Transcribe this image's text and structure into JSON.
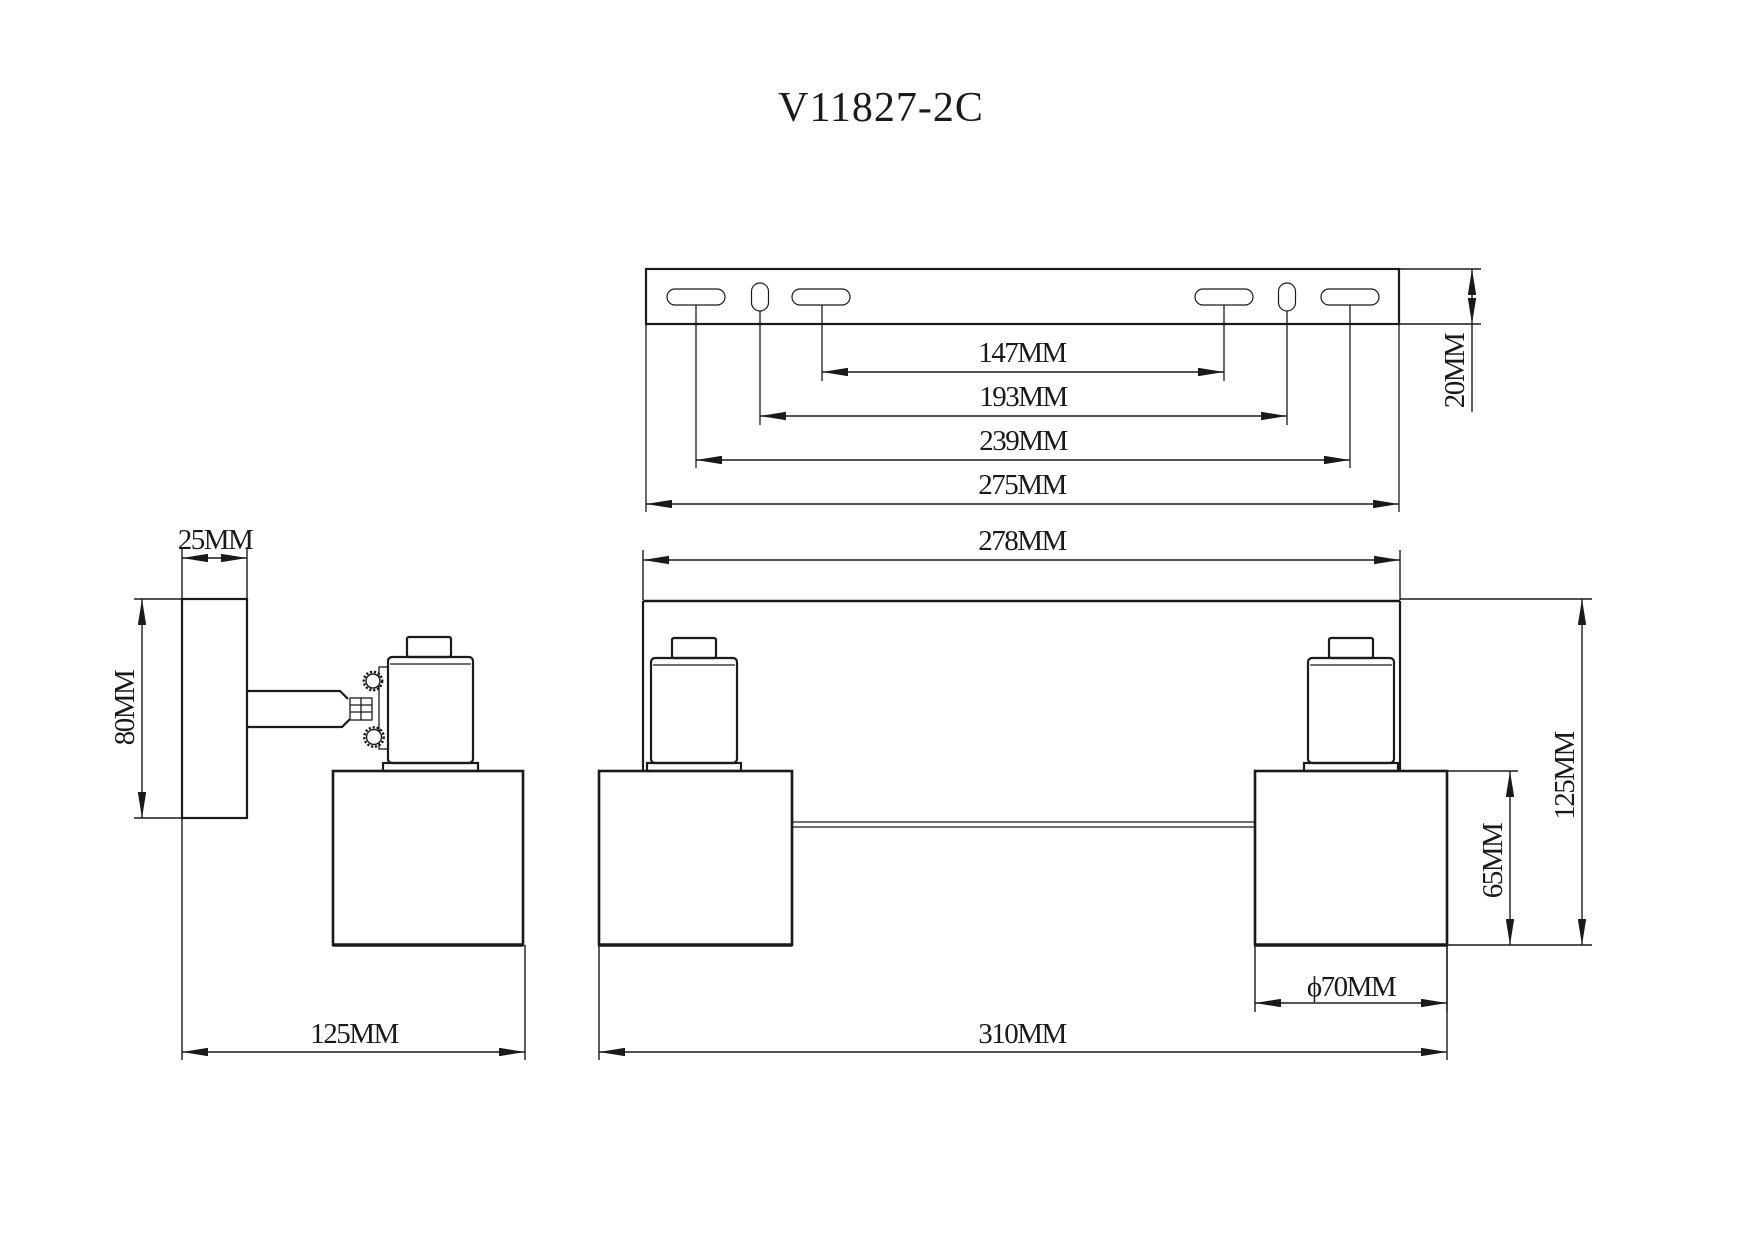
{
  "title": "V11827-2C",
  "drawing": {
    "background": "#ffffff",
    "line_color": "#1a1a1a"
  },
  "dimensions": {
    "bracket": {
      "d147": "147MM",
      "d193": "193MM",
      "d239": "239MM",
      "d275": "275MM",
      "d20": "20MM"
    },
    "front": {
      "d278": "278MM",
      "d65": "65MM",
      "d125": "125MM",
      "d70": "ϕ70MM",
      "d310": "310MM"
    },
    "side": {
      "d25": "25MM",
      "d80": "80MM",
      "d125": "125MM"
    }
  }
}
